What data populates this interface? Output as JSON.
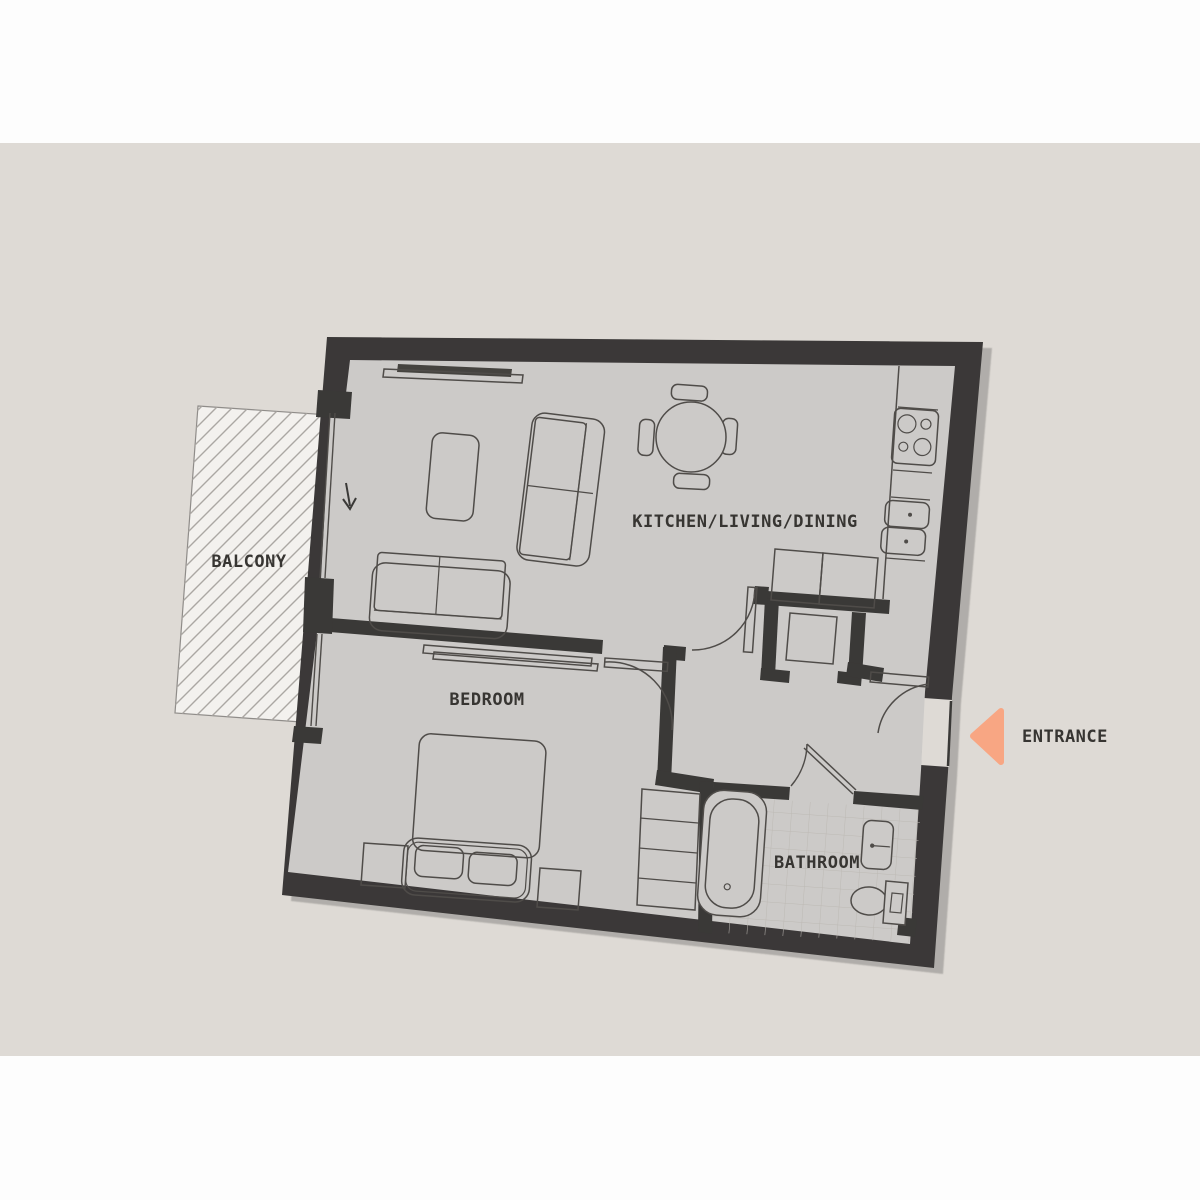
{
  "page": {
    "background": "#fdfdfd",
    "canvas_background": "#dedad5"
  },
  "floorplan": {
    "rooms": [
      {
        "id": "kitchen-living-dining",
        "label": "KITCHEN/LIVING/DINING"
      },
      {
        "id": "bedroom",
        "label": "BEDROOM"
      },
      {
        "id": "bathroom",
        "label": "BATHROOM"
      },
      {
        "id": "balcony",
        "label": "BALCONY"
      }
    ],
    "entrance": {
      "label": "ENTRANCE",
      "arrow_color": "#f8a683"
    },
    "colors": {
      "wall": "#3a3937",
      "floor": "#cccac8",
      "balcony_fill": "#f3f1ee",
      "hatch": "#aba7a3",
      "furniture_line": "#4f4c49",
      "text": "#373532",
      "tile": "#bdb9b4"
    }
  }
}
